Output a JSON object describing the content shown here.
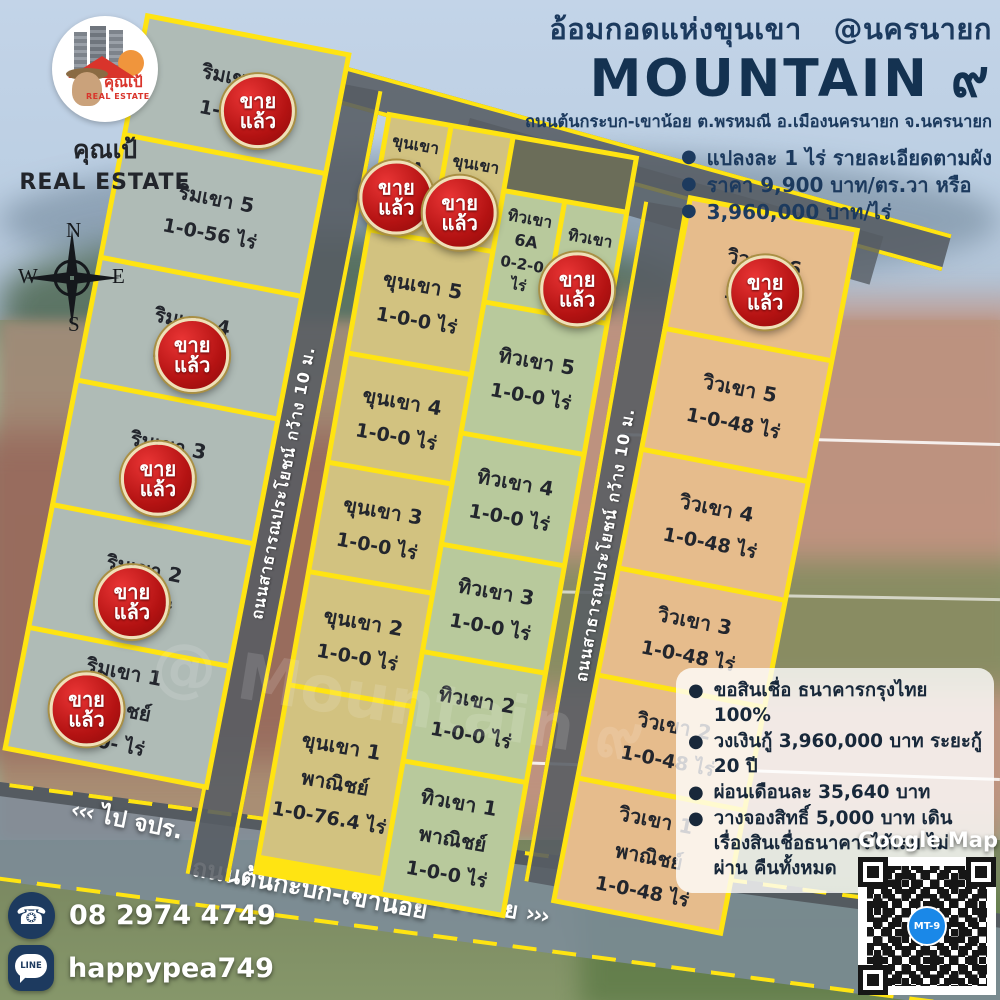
{
  "brand": {
    "logo_thai": "คุณเป้",
    "logo_en": "REAL ESTATE",
    "name_thai": "คุณเป้",
    "name_en": "REAL ESTATE"
  },
  "header": {
    "tagline": "อ้อมกอดแห่งขุนเขา   @นครนายก",
    "project_name": "MOUNTAIN ๙",
    "address": "ถนนต้นกระบก-เขาน้อย ต.พรหมณี อ.เมืองนครนายก จ.นครนายก",
    "bullets": [
      "แปลงละ 1 ไร่ รายละเอียดตามผัง",
      "ราคา 9,900 บาท/ตร.วา  หรือ",
      "3,960,000 บาท/ไร่"
    ]
  },
  "compass": {
    "n": "N",
    "s": "S",
    "e": "E",
    "w": "W"
  },
  "labels": {
    "sold_line1": "ขาย",
    "sold_line2": "แล้ว"
  },
  "plots": {
    "rim": [
      {
        "name": "ริมเขา 6",
        "area": "1-0-  ไร่",
        "sold": true
      },
      {
        "name": "ริมเขา 5",
        "area": "1-0-56 ไร่",
        "sold": false
      },
      {
        "name": "ริมเขา 4",
        "area": "1-0-  ไร่",
        "sold": true
      },
      {
        "name": "ริมเขา 3",
        "area": "1-0-  ไร่",
        "sold": true
      },
      {
        "name": "ริมเขา 2",
        "area": "1-0-  ไร่",
        "sold": true
      },
      {
        "name": "ริมเขา 1",
        "type": "พาณิชย์",
        "area": "1-0-  ไร่",
        "sold": true
      }
    ],
    "khun_top": [
      {
        "name": "ขุนเขา 6A",
        "area": "0-2-0 ไร่",
        "sold": true
      },
      {
        "name": "ขุนเขา 6B",
        "area": "ไร่",
        "sold": true
      }
    ],
    "khun": [
      {
        "name": "ขุนเขา 5",
        "area": "1-0-0 ไร่",
        "sold": false
      },
      {
        "name": "ขุนเขา 4",
        "area": "1-0-0 ไร่",
        "sold": false
      },
      {
        "name": "ขุนเขา 3",
        "area": "1-0-0 ไร่",
        "sold": false
      },
      {
        "name": "ขุนเขา 2",
        "area": "1-0-0 ไร่",
        "sold": false
      },
      {
        "name": "ขุนเขา 1",
        "type": "พาณิชย์",
        "area": "1-0-76.4 ไร่",
        "sold": false
      }
    ],
    "thiw_top": [
      {
        "name": "ทิวเขา 6A",
        "area": "0-2-0 ไร่",
        "sold": false
      },
      {
        "name": "ทิวเขา 6B",
        "area": "ไร่",
        "sold": true
      }
    ],
    "thiw": [
      {
        "name": "ทิวเขา 5",
        "area": "1-0-0 ไร่",
        "sold": false
      },
      {
        "name": "ทิวเขา 4",
        "area": "1-0-0 ไร่",
        "sold": false
      },
      {
        "name": "ทิวเขา 3",
        "area": "1-0-0 ไร่",
        "sold": false
      },
      {
        "name": "ทิวเขา 2",
        "area": "1-0-0 ไร่",
        "sold": false
      },
      {
        "name": "ทิวเขา 1",
        "type": "พาณิชย์",
        "area": "1-0-0 ไร่",
        "sold": false
      }
    ],
    "wiw": [
      {
        "name": "วิวเขา 6",
        "area": "1-0-  ไร่",
        "sold": true
      },
      {
        "name": "วิวเขา 5",
        "area": "1-0-48 ไร่",
        "sold": false
      },
      {
        "name": "วิวเขา 4",
        "area": "1-0-48 ไร่",
        "sold": false
      },
      {
        "name": "วิวเขา 3",
        "area": "1-0-48 ไร่",
        "sold": false
      },
      {
        "name": "วิวเขา 2",
        "area": "1-0-48 ไร่",
        "sold": false
      },
      {
        "name": "วิวเขา 1",
        "type": "พาณิชย์",
        "area": "1-0-48 ไร่",
        "sold": false
      }
    ]
  },
  "roads": {
    "side_label": "ถนนสาธารณประโยชน์ กว้าง 10 ม.",
    "bottom_name": "ถนนต้นกะบก-เขาน้อย",
    "to_left": "ไป จปร.",
    "to_left_arrows": "‹‹‹",
    "to_right": "ไปเขาน้อย",
    "to_right_arrows": "›››"
  },
  "finance": {
    "bullets": [
      "ขอสินเชื่อ ธนาคารกรุงไทย 100%",
      "วงเงินกู้ 3,960,000 บาท ระยะกู้ 20 ปี",
      "ผ่อนเดือนละ 35,640 บาท",
      "วางจองสิทธิ์ 5,000 บาท เดินเรื่องสินเชื่อธนาคารได้เลย ไม่ผ่าน คืนทั้งหมด"
    ]
  },
  "contact": {
    "phone": "08 2974 4749",
    "line": "happypea749"
  },
  "map_box": {
    "title": "Google Map",
    "qr_label": "MT-9"
  },
  "watermark": "@ Mountain ๙",
  "colors": {
    "accent_yellow": "#ffe412",
    "sold_red": "#b31212",
    "navy": "#1c3a5e",
    "qr_chip_blue": "#1a88e8"
  }
}
